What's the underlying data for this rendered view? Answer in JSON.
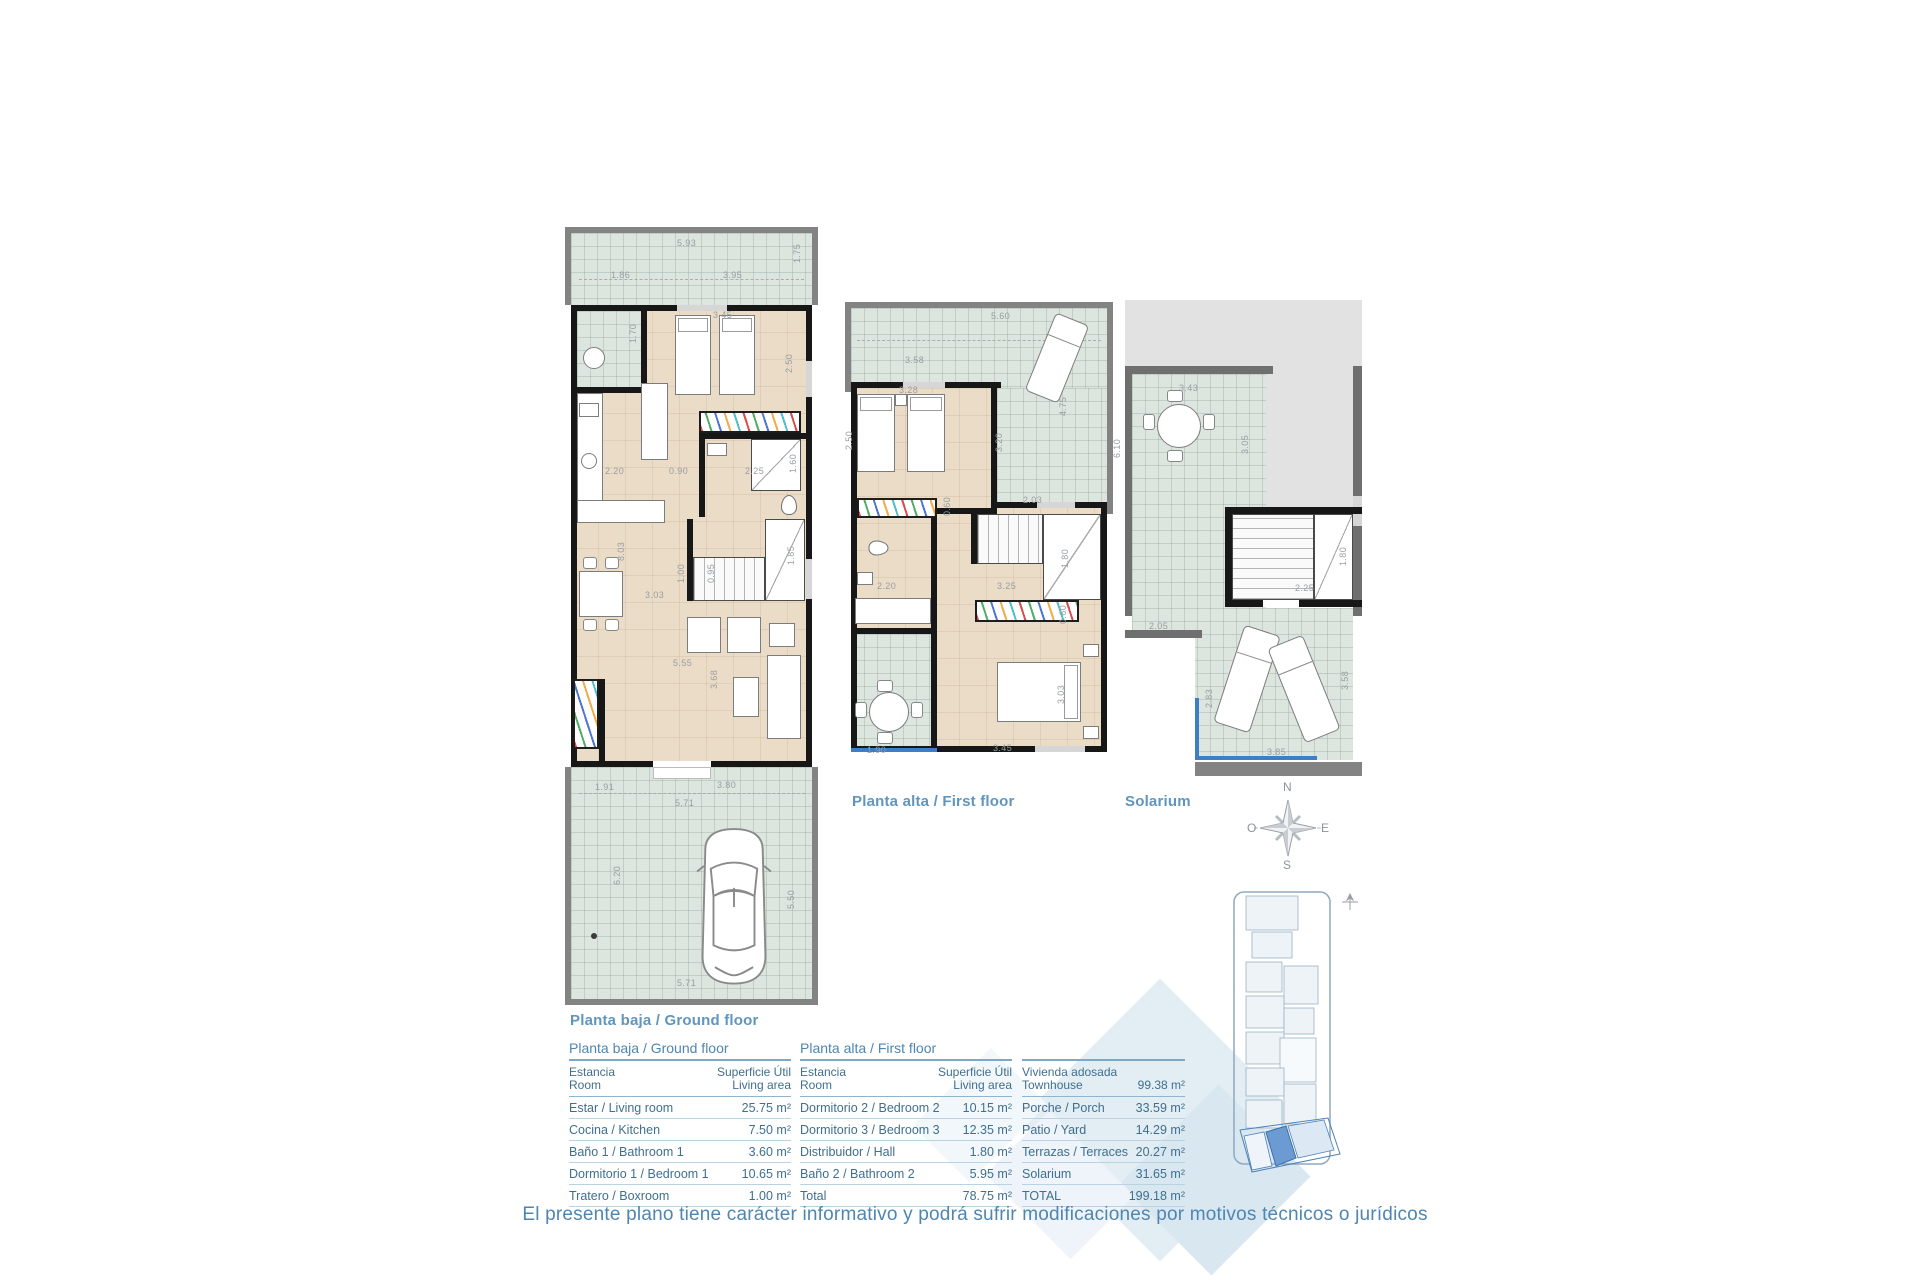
{
  "page": {
    "disclaimer": "El presente plano tiene carácter informativo y podrá sufrir modificaciones por motivos técnicos o jurídicos"
  },
  "colors": {
    "accent_blue": "#4e86b2",
    "label_blue": "#6096be",
    "highlight_unit": "#6b9bd2",
    "terrace_tile": "#dde5df",
    "interior_floor": "#ebdcc8",
    "railing_blue": "#3d7ec7"
  },
  "compass": {
    "north": "N",
    "south": "S",
    "east": "E",
    "west": "O"
  },
  "plans": {
    "ground": {
      "label": "Planta baja / Ground floor",
      "dims": [
        {
          "t": "5.93",
          "x": 112,
          "y": 12
        },
        {
          "t": "1.75",
          "x": 228,
          "y": 36,
          "v": 1
        },
        {
          "t": "1.86",
          "x": 46,
          "y": 44
        },
        {
          "t": "3.95",
          "x": 158,
          "y": 44
        },
        {
          "t": "3.45",
          "x": 148,
          "y": 84
        },
        {
          "t": "2.50",
          "x": 220,
          "y": 146,
          "v": 1
        },
        {
          "t": "1.70",
          "x": 64,
          "y": 116,
          "v": 1
        },
        {
          "t": "2.20",
          "x": 40,
          "y": 240
        },
        {
          "t": "0.90",
          "x": 104,
          "y": 240
        },
        {
          "t": "2.25",
          "x": 180,
          "y": 240
        },
        {
          "t": "1.60",
          "x": 224,
          "y": 246,
          "v": 1
        },
        {
          "t": "8.03",
          "x": 52,
          "y": 334,
          "v": 1
        },
        {
          "t": "3.03",
          "x": 80,
          "y": 364
        },
        {
          "t": "1.00",
          "x": 112,
          "y": 356,
          "v": 1
        },
        {
          "t": "0.95",
          "x": 142,
          "y": 356,
          "v": 1
        },
        {
          "t": "1.85",
          "x": 222,
          "y": 338,
          "v": 1
        },
        {
          "t": "5.55",
          "x": 108,
          "y": 432
        },
        {
          "t": "3.68",
          "x": 145,
          "y": 462,
          "v": 1
        },
        {
          "t": "1.91",
          "x": 30,
          "y": 556
        },
        {
          "t": "3.80",
          "x": 152,
          "y": 554
        },
        {
          "t": "5.71",
          "x": 110,
          "y": 572
        },
        {
          "t": "6.20",
          "x": 48,
          "y": 658,
          "v": 1
        },
        {
          "t": "5.50",
          "x": 222,
          "y": 682,
          "v": 1
        },
        {
          "t": "5.71",
          "x": 112,
          "y": 752
        }
      ]
    },
    "first": {
      "label": "Planta alta / First floor",
      "dims": [
        {
          "t": "5.60",
          "x": 146,
          "y": 10
        },
        {
          "t": "3.58",
          "x": 60,
          "y": 54
        },
        {
          "t": "3.28",
          "x": 54,
          "y": 84
        },
        {
          "t": "2.50",
          "x": 0,
          "y": 148,
          "v": 1
        },
        {
          "t": "4.75",
          "x": 214,
          "y": 114,
          "v": 1
        },
        {
          "t": "3.20",
          "x": 150,
          "y": 150,
          "v": 1
        },
        {
          "t": "2.03",
          "x": 178,
          "y": 194
        },
        {
          "t": "0.60",
          "x": 98,
          "y": 214,
          "v": 1
        },
        {
          "t": "2.20",
          "x": 32,
          "y": 280
        },
        {
          "t": "3.25",
          "x": 152,
          "y": 280
        },
        {
          "t": "1.80",
          "x": 216,
          "y": 266,
          "v": 1
        },
        {
          "t": "0.60",
          "x": 214,
          "y": 322,
          "v": 1
        },
        {
          "t": "3.03",
          "x": 212,
          "y": 402,
          "v": 1
        },
        {
          "t": "3.45",
          "x": 148,
          "y": 442
        },
        {
          "t": "1.90",
          "x": 22,
          "y": 444
        }
      ]
    },
    "solarium": {
      "label": "Solarium",
      "dims": [
        {
          "t": "6.10",
          "x": -12,
          "y": 158,
          "v": 1
        },
        {
          "t": "3.43",
          "x": 54,
          "y": 84
        },
        {
          "t": "3.05",
          "x": 116,
          "y": 154,
          "v": 1
        },
        {
          "t": "2.25",
          "x": 170,
          "y": 284
        },
        {
          "t": "1.80",
          "x": 214,
          "y": 266,
          "v": 1
        },
        {
          "t": "2.05",
          "x": 24,
          "y": 322
        },
        {
          "t": "2.83",
          "x": 80,
          "y": 408,
          "v": 1
        },
        {
          "t": "3.58",
          "x": 216,
          "y": 390,
          "v": 1
        },
        {
          "t": "3.85",
          "x": 142,
          "y": 448
        }
      ]
    }
  },
  "tables": {
    "ground": {
      "title": "Planta baja / Ground floor",
      "header": {
        "name": "Estancia\nRoom",
        "value": "Superficie Útil\nLiving area"
      },
      "rows": [
        [
          "Estar / Living room",
          "25.75 m²"
        ],
        [
          "Cocina / Kitchen",
          "7.50 m²"
        ],
        [
          "Baño 1 / Bathroom 1",
          "3.60 m²"
        ],
        [
          "Dormitorio 1 / Bedroom 1",
          "10.65 m²"
        ],
        [
          "Tratero / Boxroom",
          "1.00 m²"
        ]
      ]
    },
    "first": {
      "title": "Planta alta /  First floor",
      "header": {
        "name": "Estancia\nRoom",
        "value": "Superficie Útil\nLiving area"
      },
      "rows": [
        [
          "Dormitorio 2 / Bedroom 2",
          "10.15 m²"
        ],
        [
          "Dormitorio 3 / Bedroom 3",
          "12.35 m²"
        ],
        [
          "Distribuidor / Hall",
          "1.80 m²"
        ],
        [
          "Baño 2 / Bathroom 2",
          "5.95 m²"
        ],
        [
          "Total",
          "78.75 m²"
        ]
      ]
    },
    "summary": {
      "title": "",
      "header": {
        "name": "Vivienda adosada\nTownhouse",
        "value": "99.38 m²"
      },
      "rows": [
        [
          "Porche / Porch",
          "33.59 m²"
        ],
        [
          "Patio / Yard",
          "14.29 m²"
        ],
        [
          "Terrazas / Terraces",
          "20.27 m²"
        ],
        [
          "Solarium",
          "31.65 m²"
        ],
        [
          "TOTAL",
          "199.18 m²"
        ]
      ]
    }
  }
}
